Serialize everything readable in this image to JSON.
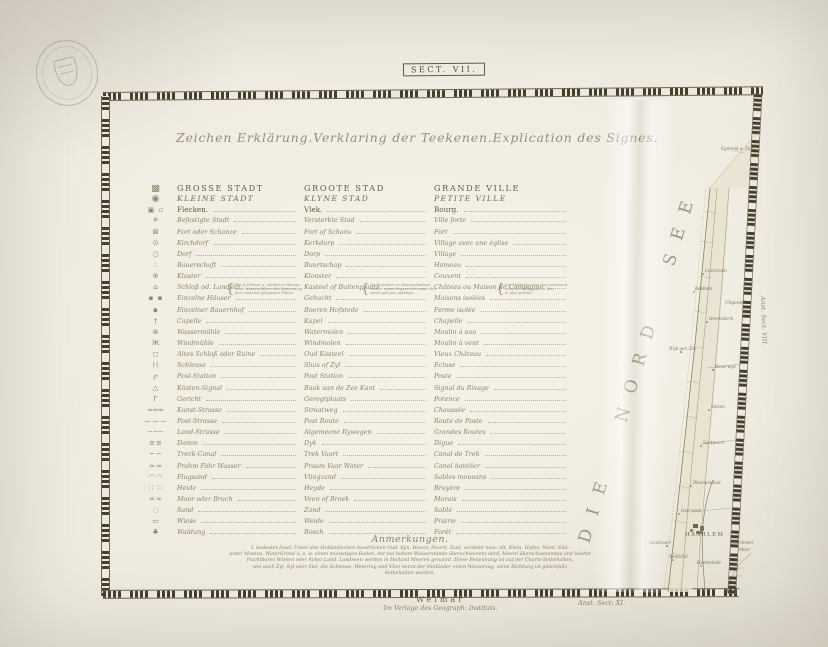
{
  "page": {
    "sect_label": "SECT. VII."
  },
  "colors": {
    "paper": "#ebe7dc",
    "ink_dark": "#574f3e",
    "ink_faded": "#8d8467",
    "border_tick": "#463f30",
    "map_line": "#9c9172"
  },
  "heading": {
    "de": "Zeichen Erklärung.",
    "nl": "Verklaring der Teekenen.",
    "fr": "Explication des Signes."
  },
  "legend": {
    "rows": [
      {
        "icon": "large-city",
        "glyph": "▩",
        "style": "caps1",
        "de": "GROSSE STADT",
        "nl": "GROOTE STAD",
        "fr": "GRANDE VILLE"
      },
      {
        "icon": "small-city",
        "glyph": "◉",
        "style": "caps2",
        "de": "KLEINE STADT",
        "nl": "KLYNE STAD",
        "fr": "PETITE VILLE"
      },
      {
        "icon": "market-town",
        "glyph": "▣ ▫",
        "style": "plain",
        "de": "Flecken.",
        "nl": "Vlek.",
        "fr": "Bourg."
      },
      {
        "icon": "fortified-town",
        "glyph": "✳",
        "style": "entry",
        "de": "Befestigte Stadt",
        "nl": "Versterkte Stad",
        "fr": "Ville forte"
      },
      {
        "icon": "fort-redoubt",
        "glyph": "⊠",
        "style": "entry",
        "de": "Fort oder Schanze",
        "nl": "Fort of Schans",
        "fr": "Fort"
      },
      {
        "icon": "church-village",
        "glyph": "⊙",
        "style": "entry",
        "de": "Kirchdorf",
        "nl": "Kerkdorp",
        "fr": "Village avec une église"
      },
      {
        "icon": "village",
        "glyph": "○",
        "style": "entry",
        "de": "Dorf",
        "nl": "Dorp",
        "fr": "Village"
      },
      {
        "icon": "hamlet",
        "glyph": "∴",
        "style": "entry",
        "de": "Bauerschaft",
        "nl": "Buurtschap",
        "fr": "Hameau"
      },
      {
        "icon": "monastery",
        "glyph": "⊕",
        "style": "entry",
        "de": "Kloster",
        "nl": "Klooster",
        "fr": "Couvent"
      },
      {
        "icon": "castle-estate",
        "glyph": "⌂",
        "style": "entry",
        "de": "Schloß od. Landsitz",
        "nl": "Kasteel of Buitenplaats",
        "fr": "Château ou Maison de Campagne"
      },
      {
        "icon": "isolated-houses",
        "glyph": "▪ ▪",
        "style": "entry",
        "de": "Einzelne Häuser",
        "nl": "Gehucht",
        "fr": "Maisons isolées"
      },
      {
        "icon": "single-farm",
        "glyph": "▪",
        "style": "entry",
        "de": "Einzelner Bauernhof",
        "nl": "Boeren Hofstede",
        "fr": "Ferme isolée"
      },
      {
        "icon": "chapel",
        "glyph": "†",
        "style": "entry",
        "de": "Capelle",
        "nl": "Kapel",
        "fr": "Chapelle"
      },
      {
        "icon": "water-mill",
        "glyph": "⊗",
        "style": "entry",
        "de": "Wassermühle",
        "nl": "Watermolen",
        "fr": "Moulin à eau"
      },
      {
        "icon": "windmill",
        "glyph": "Ж",
        "style": "entry",
        "de": "Windmühle",
        "nl": "Windmolen",
        "fr": "Moulin à vent"
      },
      {
        "icon": "old-castle-ruin",
        "glyph": "◻",
        "style": "entry",
        "de": "Altes Schloß oder Ruine",
        "nl": "Oud Kasteel",
        "fr": "Vieux Château"
      },
      {
        "icon": "sluice",
        "glyph": ")(",
        "style": "entry",
        "de": "Schleuse",
        "nl": "Sluis of Zyl",
        "fr": "Écluse"
      },
      {
        "icon": "post-station",
        "glyph": "℘",
        "style": "entry",
        "de": "Post-Station",
        "nl": "Post Station",
        "fr": "Poste"
      },
      {
        "icon": "coast-beacon",
        "glyph": "△",
        "style": "entry",
        "de": "Küsten-Signal",
        "nl": "Baak aan de Zee Kant",
        "fr": "Signal du Rivage"
      },
      {
        "icon": "gallows",
        "glyph": "Γ",
        "style": "entry",
        "de": "Gericht",
        "nl": "Geregtplaats",
        "fr": "Potence"
      },
      {
        "icon": "paved-highway",
        "glyph": "═══",
        "style": "entry",
        "de": "Kunst-Strasse",
        "nl": "Straatweg",
        "fr": "Chaussée"
      },
      {
        "icon": "post-road",
        "glyph": "———",
        "style": "entry",
        "de": "Post-Strasse",
        "nl": "Post Route",
        "fr": "Route de Poste"
      },
      {
        "icon": "country-road",
        "glyph": "╌╌╌",
        "style": "entry",
        "de": "Land-Strasse",
        "nl": "Algemeene Rywegen",
        "fr": "Grandes Routes"
      },
      {
        "icon": "dike",
        "glyph": "≡≡",
        "style": "entry",
        "de": "Damm",
        "nl": "Dyk",
        "fr": "Digue"
      },
      {
        "icon": "tow-canal",
        "glyph": "~~",
        "style": "entry",
        "de": "Treck-Canal",
        "nl": "Trek Vaart",
        "fr": "Canal de Trek"
      },
      {
        "icon": "barge-waterway",
        "glyph": "≈≈",
        "style": "entry",
        "de": "Prahm Fahr Wasser",
        "nl": "Praam Vaar Water",
        "fr": "Canal batelier"
      },
      {
        "icon": "drift-sand",
        "glyph": "◠◠",
        "style": "entry",
        "de": "Flugsand",
        "nl": "Vliegzand",
        "fr": "Sables mouvans"
      },
      {
        "icon": "heath",
        "glyph": "∷ ∷",
        "style": "entry",
        "de": "Heide",
        "nl": "Heyde",
        "fr": "Bruyère"
      },
      {
        "icon": "moor-marsh",
        "glyph": "≍≍",
        "style": "entry",
        "de": "Moor oder Bruch",
        "nl": "Veen of Broek",
        "fr": "Marais"
      },
      {
        "icon": "sand",
        "glyph": "◌",
        "style": "entry",
        "de": "Sand",
        "nl": "Zand",
        "fr": "Sable"
      },
      {
        "icon": "meadow",
        "glyph": "▭",
        "style": "entry",
        "de": "Wiese",
        "nl": "Weide",
        "fr": "Prairie"
      },
      {
        "icon": "woodland",
        "glyph": "♣",
        "style": "entry",
        "de": "Waldung",
        "nl": "Bosch",
        "fr": "Forêt"
      }
    ],
    "notes": {
      "de": [
        "Die Schlösser u. adelichen Häuser",
        "ohne Namen führen die Benennung",
        "der zunächst gelegenen Plätze."
      ],
      "nl": [
        "De Kasteelen en Buitenplaatsen",
        "zonder naam dragen den naam der",
        "naast gelegen plaatsen."
      ],
      "fr": [
        "Les châteaux sans nom prennent",
        "celui du village ou du lieu",
        "le plus proche."
      ]
    }
  },
  "remarks": {
    "title": "Anmerkungen.",
    "lines": [
      "I. bedeutet Insel. Unter den Holländischen Ausdrücken Oud, Kyn, Haven, Noord, Zuid, versteht man: Alt, Klein, Hafen, Nord, Süd;",
      "unter Moeras, WaterGrond u. s. w. einen morastigen Boden, der bei hohem Wasserstande überschwemmt wird; Meere überschwemmtes und höchst",
      "fruchtbares Wiesen oder Acker Land. Landseen werden in Holland Meeren genannt. Diese Benennung ist auf der Charte beibehalten,",
      "wie auch Zyl, Syl oder Siel, die Schleuse. Wetering und Vliet nennt der Holländer einen Wasserzug, seine Richtung ist gleichfalls",
      "beibehalten worden."
    ]
  },
  "map": {
    "sea_label": "DIE NORD SEE",
    "edge_label_right": "Anst. Sect: VIII.",
    "edge_label_bottom": "Anst. Sect: XI.",
    "labels": [
      {
        "text": "Egmond a. Zee",
        "x": 166,
        "y": 58,
        "size": 3.6
      },
      {
        "text": "Castricum",
        "x": 150,
        "y": 180
      },
      {
        "text": "Bakkum",
        "x": 140,
        "y": 198
      },
      {
        "text": "Uitgeest",
        "x": 170,
        "y": 212,
        "size": 3.6
      },
      {
        "text": "Heemskerk",
        "x": 154,
        "y": 228
      },
      {
        "text": "Wyk aan Zee",
        "x": 114,
        "y": 258
      },
      {
        "text": "Beverwyk",
        "x": 160,
        "y": 276
      },
      {
        "text": "Velsen",
        "x": 156,
        "y": 316
      },
      {
        "text": "Santpoort",
        "x": 148,
        "y": 352
      },
      {
        "text": "Bloemendaal",
        "x": 138,
        "y": 392
      },
      {
        "text": "Overveen",
        "x": 126,
        "y": 420
      },
      {
        "text": "HAARLEM",
        "x": 130,
        "y": 444,
        "caps": true
      },
      {
        "text": "Sandvoort",
        "x": 94,
        "y": 452
      },
      {
        "text": "Bentveld",
        "x": 114,
        "y": 466
      },
      {
        "text": "Heemstede",
        "x": 142,
        "y": 472
      },
      {
        "text": "Haarlemer",
        "x": 176,
        "y": 452,
        "size": 3.8
      },
      {
        "text": "Meer",
        "x": 184,
        "y": 459,
        "size": 3.8
      }
    ]
  },
  "imprint": {
    "city": "Weimar",
    "publisher": "Im Verlage des Geograph: Instituts."
  }
}
